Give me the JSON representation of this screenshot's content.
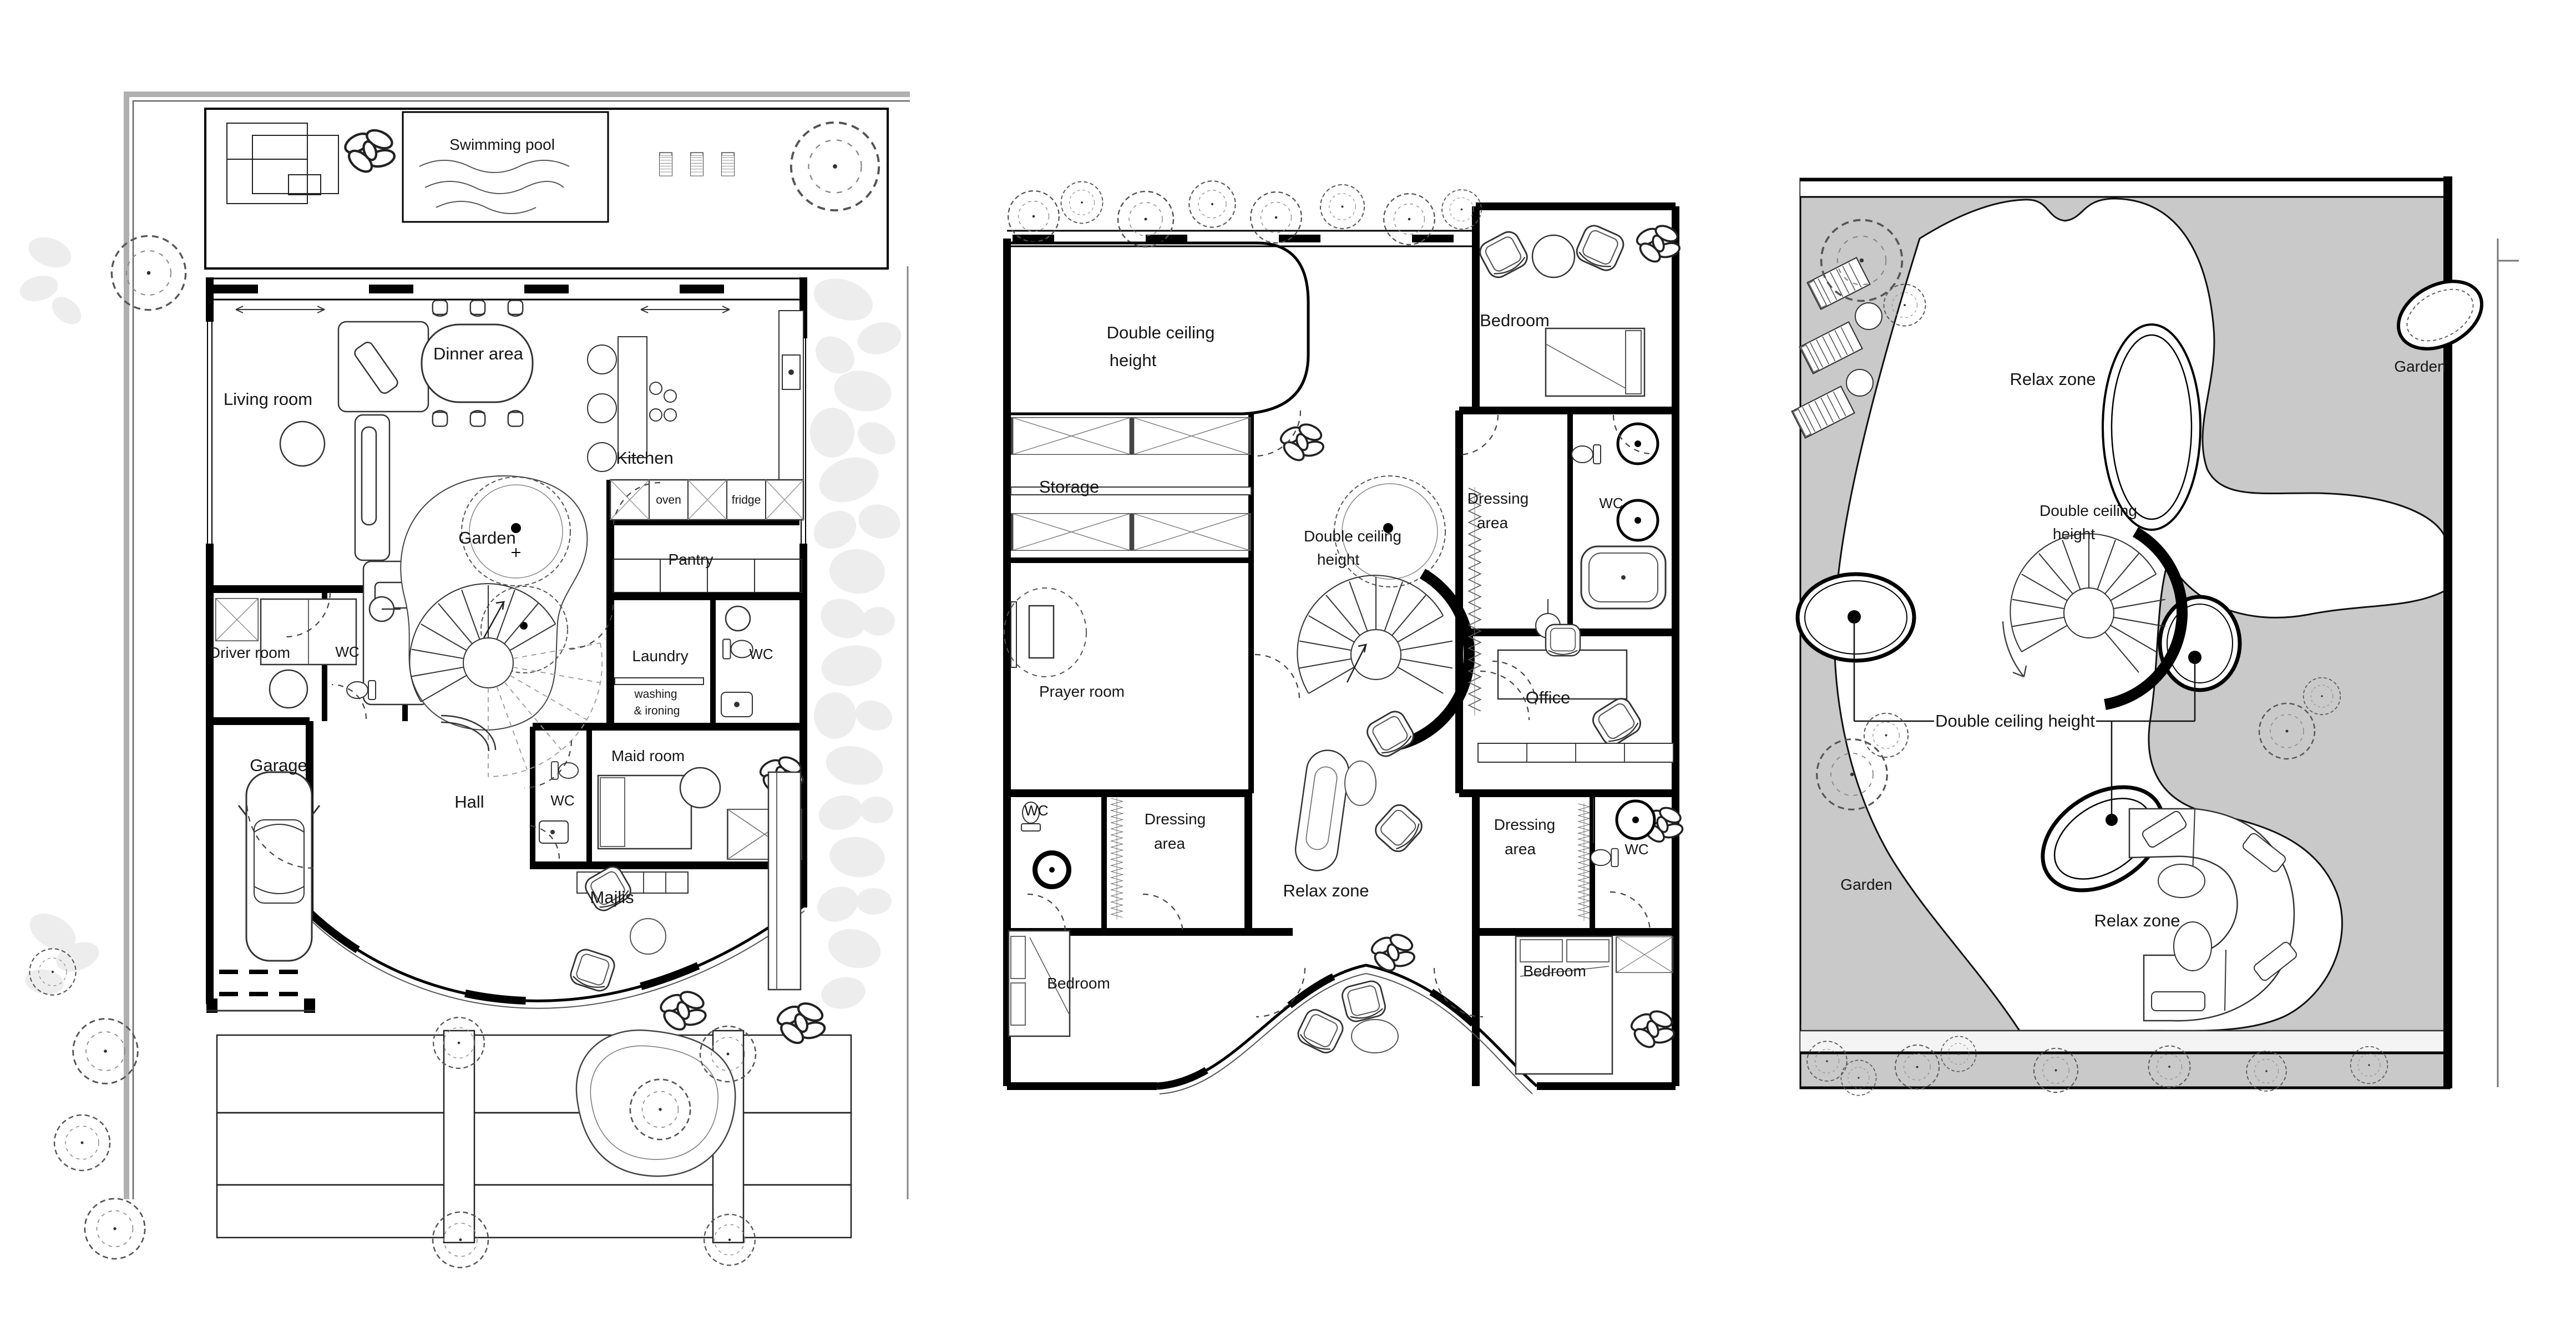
{
  "canvas": {
    "background": "#ffffff",
    "line_color": "#000000",
    "garden_gray": "#c9c9c9",
    "boundary_gray": "#a8a8a8",
    "stone_gray": "#ededed",
    "text_color": "#161616"
  },
  "plans": [
    {
      "id": "ground-floor-plan",
      "labels": {
        "swimming_pool": "Swimming pool",
        "living_room": "Living room",
        "dinner_area": "Dinner area",
        "kitchen": "Kitchen",
        "oven": "oven",
        "fridge": "fridge",
        "garden": "Garden",
        "pantry": "Pantry",
        "driver_room": "Driver room",
        "wc_driver": "WC",
        "laundry": "Laundry",
        "wc_laundry": "WC",
        "washing_line1": "washing",
        "washing_line2": "& ironing",
        "garage": "Garage",
        "hall": "Hall",
        "maid_room": "Maid room",
        "wc_maid": "WC",
        "majlis": "Majlis"
      }
    },
    {
      "id": "first-floor-plan",
      "labels": {
        "double_ceiling_line1": "Double ceiling",
        "double_ceiling_line2": "height",
        "bedroom_top": "Bedroom",
        "storage": "Storage",
        "dressing_top_line1": "Dressing",
        "dressing_top_line2": "area",
        "wc_top": "WC",
        "stair_double_line1": "Double ceiling",
        "stair_double_line2": "height",
        "prayer_room": "Prayer room",
        "office": "Office",
        "wc_left": "WC",
        "dressing_left_line1": "Dressing",
        "dressing_left_line2": "area",
        "relax_zone": "Relax zone",
        "dressing_right_line1": "Dressing",
        "dressing_right_line2": "area",
        "wc_right": "WC",
        "bedroom_bottom_left": "Bedroom",
        "bedroom_bottom_right": "Bedroom"
      }
    },
    {
      "id": "roof-plan",
      "labels": {
        "relax_zone_top": "Relax zone",
        "garden_top": "Garden",
        "stair_double_line1": "Double ceiling",
        "stair_double_line2": "height",
        "double_ceiling_callout": "Double ceiling height",
        "garden_bottom": "Garden",
        "relax_zone_bottom": "Relax zone"
      }
    }
  ]
}
